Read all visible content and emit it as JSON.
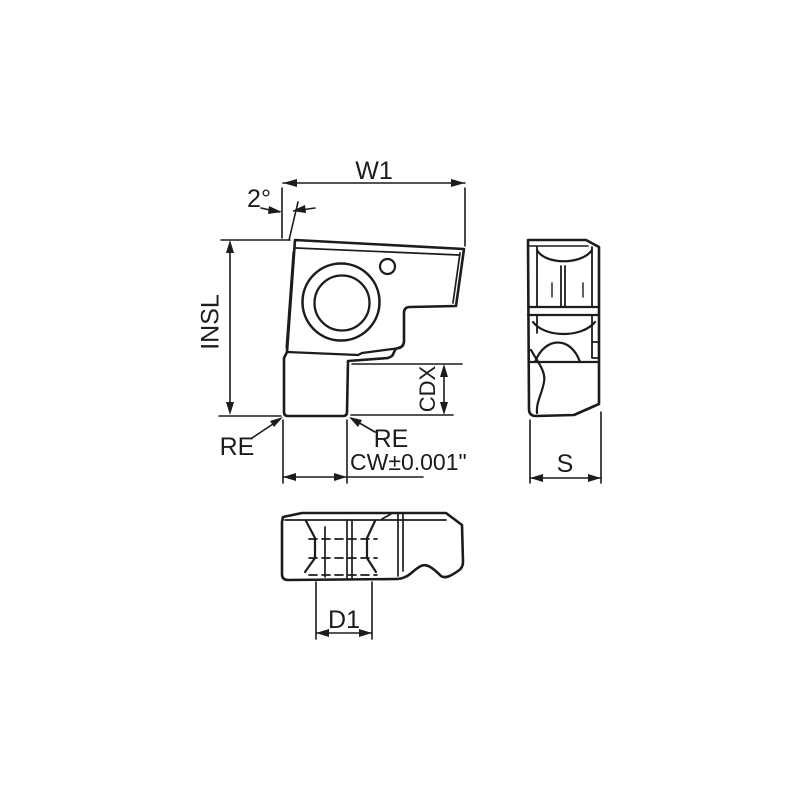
{
  "page": {
    "background": "#ffffff",
    "line_color": "#1c1c1c"
  },
  "drawing": {
    "type": "technical-drawing",
    "subject": "grooving insert with three orthographic views (front, side, bottom)",
    "dimensions": {
      "w1": {
        "label": "W1"
      },
      "angle": {
        "label": "2°"
      },
      "insl": {
        "label": "INSL"
      },
      "cdx": {
        "label": "CDX"
      },
      "re_left": {
        "label": "RE"
      },
      "re_right": {
        "label": "RE"
      },
      "cw": {
        "label": "CW±0.001\""
      },
      "s": {
        "label": "S"
      },
      "d1": {
        "label": "D1"
      }
    }
  }
}
